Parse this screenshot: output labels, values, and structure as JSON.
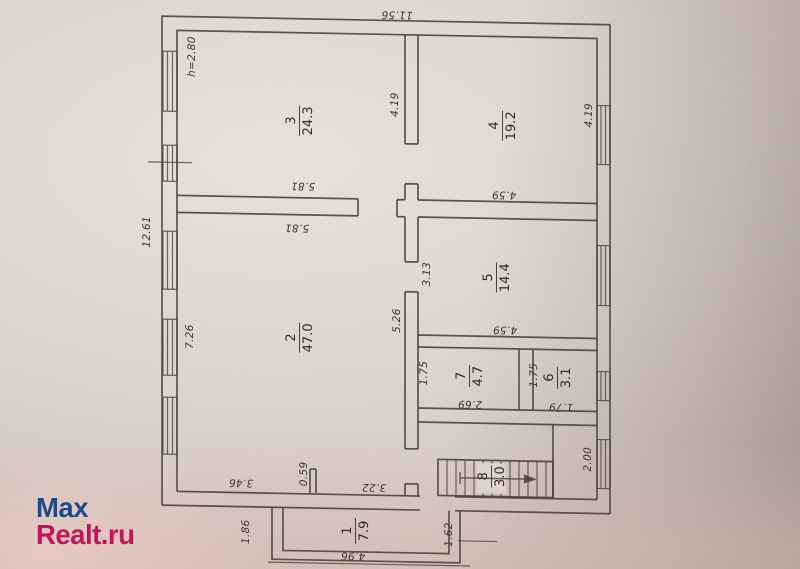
{
  "logo": {
    "line1": "Max",
    "line2": "Realt.ru",
    "color1": "#1d4a88",
    "color2": "#c41358"
  },
  "plan": {
    "ceiling_height_label": "h=2.80",
    "overall_width_label": "11.56",
    "overall_height_label": "12.61",
    "rooms": [
      {
        "num": "1",
        "area": "7.9",
        "x": 355,
        "y": 528,
        "rot": -90,
        "bar": 13
      },
      {
        "num": "2",
        "area": "47.0",
        "x": 299,
        "y": 336,
        "rot": -90,
        "bar": 15
      },
      {
        "num": "3",
        "area": "24.3",
        "x": 299,
        "y": 119,
        "rot": -90,
        "bar": 15
      },
      {
        "num": "4",
        "area": "19.2",
        "x": 502,
        "y": 120,
        "rot": -90,
        "bar": 15
      },
      {
        "num": "5",
        "area": "14.4",
        "x": 496,
        "y": 272,
        "rot": -90,
        "bar": 15
      },
      {
        "num": "6",
        "area": "3.1",
        "x": 557,
        "y": 371,
        "rot": -90,
        "bar": 11
      },
      {
        "num": "7",
        "area": "4.7",
        "x": 469,
        "y": 371,
        "rot": -90,
        "bar": 11
      },
      {
        "num": "8",
        "area": "3.0",
        "x": 491,
        "y": 471,
        "rot": -90,
        "bar": 11
      }
    ],
    "dims": [
      {
        "text": "11.56",
        "x": 397,
        "y": 11,
        "rot": 180
      },
      {
        "text": "12.61",
        "x": 147,
        "y": 233,
        "rot": -90
      },
      {
        "text": "h=2.80",
        "x": 192,
        "y": 57,
        "rot": -90
      },
      {
        "text": "4.19",
        "x": 395,
        "y": 101,
        "rot": -90
      },
      {
        "text": "5.81",
        "x": 303,
        "y": 184,
        "rot": 180
      },
      {
        "text": "4.59",
        "x": 504,
        "y": 189,
        "rot": 180
      },
      {
        "text": "4.19",
        "x": 589,
        "y": 108,
        "rot": -90
      },
      {
        "text": "5.81",
        "x": 297,
        "y": 226,
        "rot": 180
      },
      {
        "text": "7.26",
        "x": 190,
        "y": 337,
        "rot": -90
      },
      {
        "text": "5.26",
        "x": 397,
        "y": 317,
        "rot": -90
      },
      {
        "text": "3.13",
        "x": 427,
        "y": 270,
        "rot": -90
      },
      {
        "text": "4.59",
        "x": 505,
        "y": 324,
        "rot": 180
      },
      {
        "text": "1.75",
        "x": 424,
        "y": 369,
        "rot": -90
      },
      {
        "text": "2.69",
        "x": 470,
        "y": 399,
        "rot": 180
      },
      {
        "text": "1.75",
        "x": 534,
        "y": 369,
        "rot": -90
      },
      {
        "text": "1.79",
        "x": 561,
        "y": 400,
        "rot": 180
      },
      {
        "text": "2.00",
        "x": 588,
        "y": 452,
        "rot": -90
      },
      {
        "text": "3.46",
        "x": 241,
        "y": 482,
        "rot": 180
      },
      {
        "text": "0.59",
        "x": 304,
        "y": 472,
        "rot": -90
      },
      {
        "text": "3.22",
        "x": 374,
        "y": 484,
        "rot": 180
      },
      {
        "text": "1.86",
        "x": 246,
        "y": 531,
        "rot": -90
      },
      {
        "text": "1.62",
        "x": 449,
        "y": 530,
        "rot": -90
      },
      {
        "text": "4.96",
        "x": 353,
        "y": 553,
        "rot": 180
      }
    ]
  }
}
